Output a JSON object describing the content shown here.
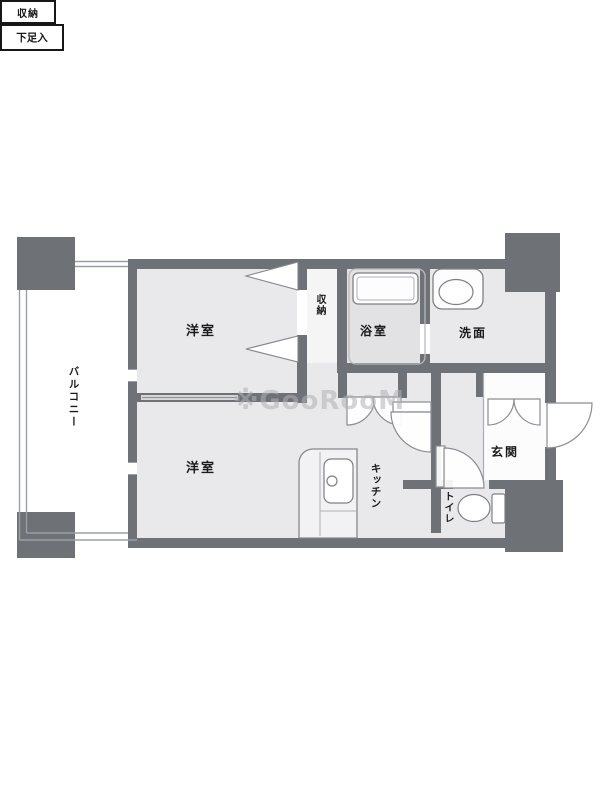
{
  "watermark": "※GooRooM",
  "labels": {
    "balcony": "バルコニー",
    "bedroom_top": "洋室",
    "bedroom_bottom": "洋室",
    "closet_top": "収納",
    "bathroom": "浴室",
    "washroom": "洗面",
    "closet_hall": "収納",
    "shoe_cabinet": "下足入",
    "entrance": "玄関",
    "kitchen": "キッチン",
    "toilet": "トイレ"
  },
  "colors": {
    "wall": "#6e7176",
    "floor": "#e9e9eb",
    "bath_floor": "#e2e2e4",
    "closet_floor": "#f5f5f6",
    "genkan_floor": "#fcfcfd",
    "fixture_outline": "#7d8085",
    "thin_line": "#9aa0a5",
    "text": "#1b1b1d",
    "watermark_gray": "#b0b0b6"
  }
}
